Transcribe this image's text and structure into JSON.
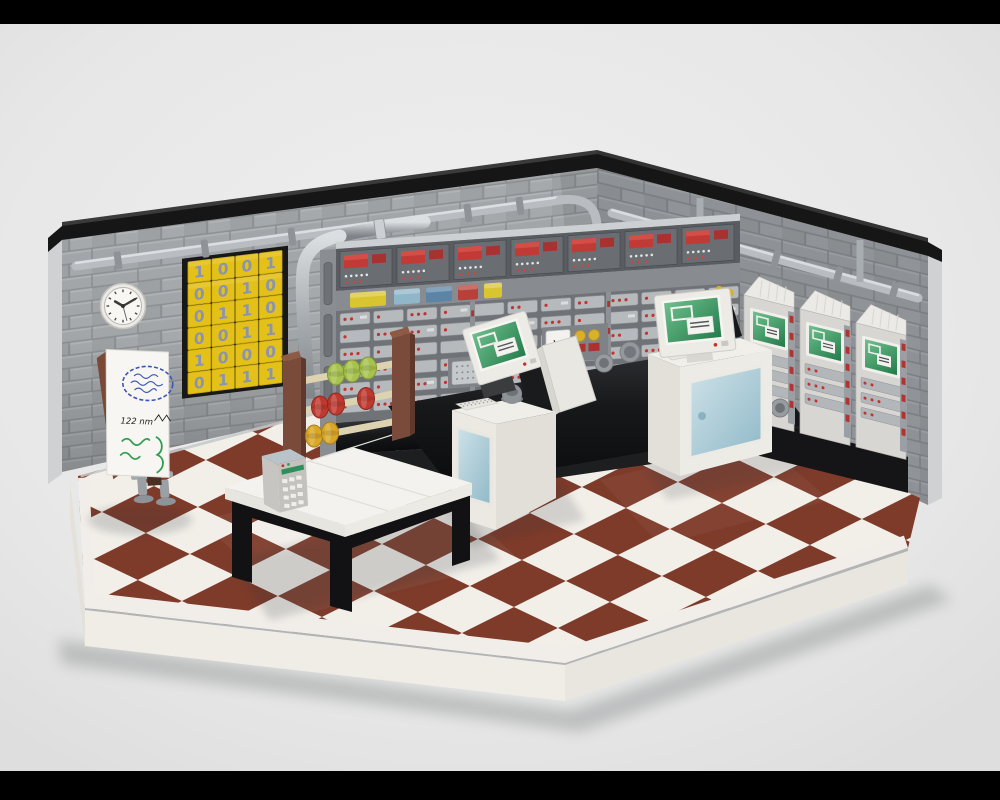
{
  "frame": {
    "top_bar": "#000000",
    "bottom_bar": "#000000"
  },
  "scene": {
    "description": "3D rendered LEGO MOC diorama of a retro mainframe computer room",
    "floor_style": "brown and white checkerboard tiles",
    "wall_style": "grey brick with black coping and grey pipes"
  },
  "colors": {
    "wall_side": "#cfd1d3",
    "coping_black": "#161616",
    "pipe_grey": "#b9bdc1",
    "pipe_highlight": "#e2e5e7",
    "clamp_grey": "#8f9397",
    "floor_brown": "#7e3b2a",
    "floor_white": "#f2efe9",
    "floor_border": "#f1eee9",
    "base_white": "#f0ede7",
    "base_side": "#e9e6e0",
    "base_strip": "#b2b5b8",
    "mainframe_dark": "#595c60",
    "mainframe_mid": "#6f7276",
    "slat_grey": "#b7babd",
    "indicator_red": "#c2332f",
    "panel_red": "#c13a35",
    "light_yellow": "#d9c530",
    "light_cyan": "#8fb6c9",
    "light_blue": "#5b84a6",
    "light_red": "#b84038",
    "console_black": "#151517",
    "cabinet_white": "#d8d6d2",
    "monitor_white": "#edebe6",
    "screen_green": "#2f8f5b",
    "glass_blue": "#a9cdd9",
    "table_white": "#f4f2ee",
    "table_black": "#121214",
    "abacus_brown": "#7a4b3b",
    "rod_tan": "#ded3b0",
    "bead_green": "#a8c24e",
    "bead_red": "#c0392f",
    "bead_yellow": "#d9a627",
    "calc_grey": "#c7c5c1",
    "calc_display": "#2f8f5b",
    "poster_yellow": "#e4c118",
    "poster_digit": "#8a93b0",
    "poster_backing": "#181818",
    "board_white": "#f7f6f2",
    "board_brown": "#7b4a37",
    "marker_blue": "#3b55b5",
    "marker_green": "#2f9e4e",
    "stand_grey": "#9aa0a5",
    "clock_face": "#f8f7f4",
    "clock_rim": "#d8d5d0",
    "clock_hand": "#3a3a3a",
    "shadow": "#55585a"
  },
  "clock": {
    "hour_hand": 10,
    "minute_hand": 2,
    "second_hand": 5.5
  },
  "poster": {
    "rows": 6,
    "cols": 4,
    "grid": [
      [
        "1",
        "0",
        "0",
        "1"
      ],
      [
        "0",
        "0",
        "1",
        "0"
      ],
      [
        "0",
        "1",
        "1",
        "0"
      ],
      [
        "0",
        "0",
        "1",
        "1"
      ],
      [
        "1",
        "0",
        "0",
        "0"
      ],
      [
        "0",
        "1",
        "1",
        "1"
      ]
    ]
  },
  "whiteboard": {
    "visible_text": "122 nm"
  },
  "mainframe": {
    "top_panel_units": 7,
    "slat_rows": 6,
    "slat_cols": 12,
    "red_dot_pattern": [
      2,
      1,
      3,
      1,
      0,
      2,
      1,
      2,
      3,
      1,
      2,
      0,
      1,
      3,
      2,
      1
    ]
  },
  "right_cabinets": {
    "units": 3,
    "slat_rows": 3
  },
  "workstations": {
    "count": 2
  },
  "base": {
    "vent_groups": 2,
    "holes_per_group": 3
  }
}
